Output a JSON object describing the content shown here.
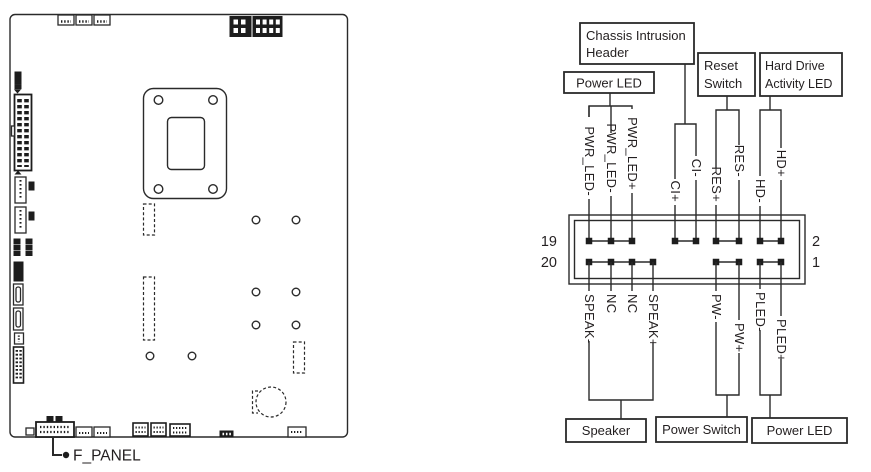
{
  "figure": {
    "board_callout": "F_PANEL",
    "pin_numbers": {
      "top_left": "19",
      "bottom_left": "20",
      "top_right": "2",
      "bottom_right": "1"
    },
    "boxes": {
      "chassis_intrusion": {
        "line1": "Chassis Intrusion",
        "line2": "Header"
      },
      "power_led_top": {
        "line1": "Power LED"
      },
      "reset_switch": {
        "line1": "Reset",
        "line2": "Switch"
      },
      "hdd_led": {
        "line1": "Hard Drive",
        "line2": "Activity LED"
      },
      "speaker": {
        "line1": "Speaker"
      },
      "power_switch": {
        "line1": "Power Switch"
      },
      "power_led_bottom": {
        "line1": "Power LED"
      }
    },
    "top_pins": [
      "PWR_LED-",
      "PWR_LED-",
      "PWR_LED+",
      "CI+",
      "CI-",
      "RES+",
      "RES-",
      "HD-",
      "HD+"
    ],
    "bottom_pins": [
      "SPEAK-",
      "NC",
      "NC",
      "SPEAK+",
      "PW-",
      "PW+",
      "PLED-",
      "PLED+"
    ],
    "colors": {
      "line": "#2a2a2a",
      "text": "#231f20"
    }
  }
}
